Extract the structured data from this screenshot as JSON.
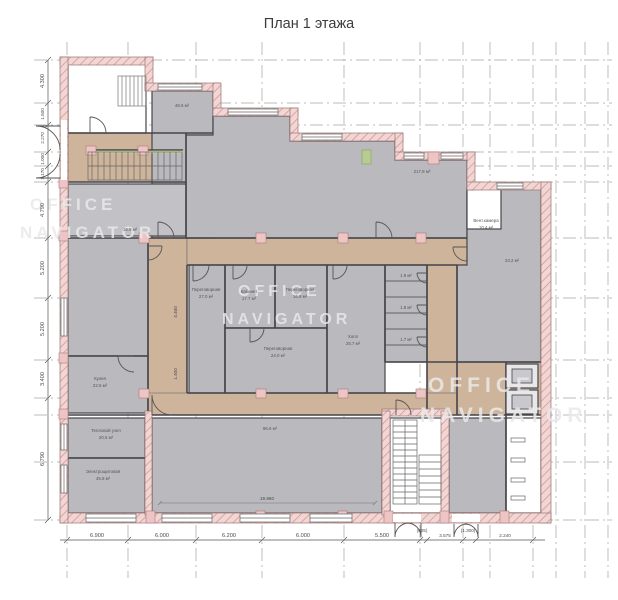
{
  "title": "План 1 этажа",
  "watermark": {
    "line1": "OFFICE",
    "line2": "NAVIGATOR"
  },
  "dims": {
    "left": [
      "4.300",
      "1.500",
      "2.270",
      "1.000",
      "1.170",
      "4.790",
      "5.200",
      "5.200",
      "3.400",
      "6.790"
    ],
    "bottom": [
      "6.900",
      "6.000",
      "6.200",
      "6.000",
      "5.500",
      "(625)",
      "3.575",
      "(1.300)",
      "2.240"
    ],
    "inner_width": "19.960",
    "corridor1": "4.400",
    "corridor2": "1.400"
  },
  "rooms": {
    "a1_area": "48.6 м²",
    "open_top_area": "217.8 м²",
    "vent_name": "Вент.камера",
    "vent_area": "10.4 м²",
    "right_area": "23.2 м²",
    "server_area": "16.9 м²",
    "m1_name": "Переговорная",
    "m1_area": "27.0 м²",
    "m2_name": "Кабинет",
    "m2_area": "17.7 м²",
    "m3_name": "Переговорная",
    "m3_area": "16.8 м²",
    "m4_name": "Переговорная",
    "m4_area": "24.0 м²",
    "hall_name": "Холл",
    "hall_area": "25.7 м²",
    "wc1_area": "1.9 м²",
    "wc2_area": "1.8 м²",
    "wc3_area": "1.7 м²",
    "kitchen_name": "Кухня",
    "kitchen_area": "22.5 м²",
    "heat_name": "Тепловой узел",
    "heat_area": "20.5 м²",
    "electric_name": "Электрощитовая",
    "electric_area": "45.8 м²",
    "open_bottom_area": "96.6 м²"
  },
  "colors": {
    "room_gray": "#b9b9be",
    "corridor_tan": "#cfb49c",
    "wall_pink": "#f2d6d4",
    "hatch_red": "#cf9090"
  }
}
